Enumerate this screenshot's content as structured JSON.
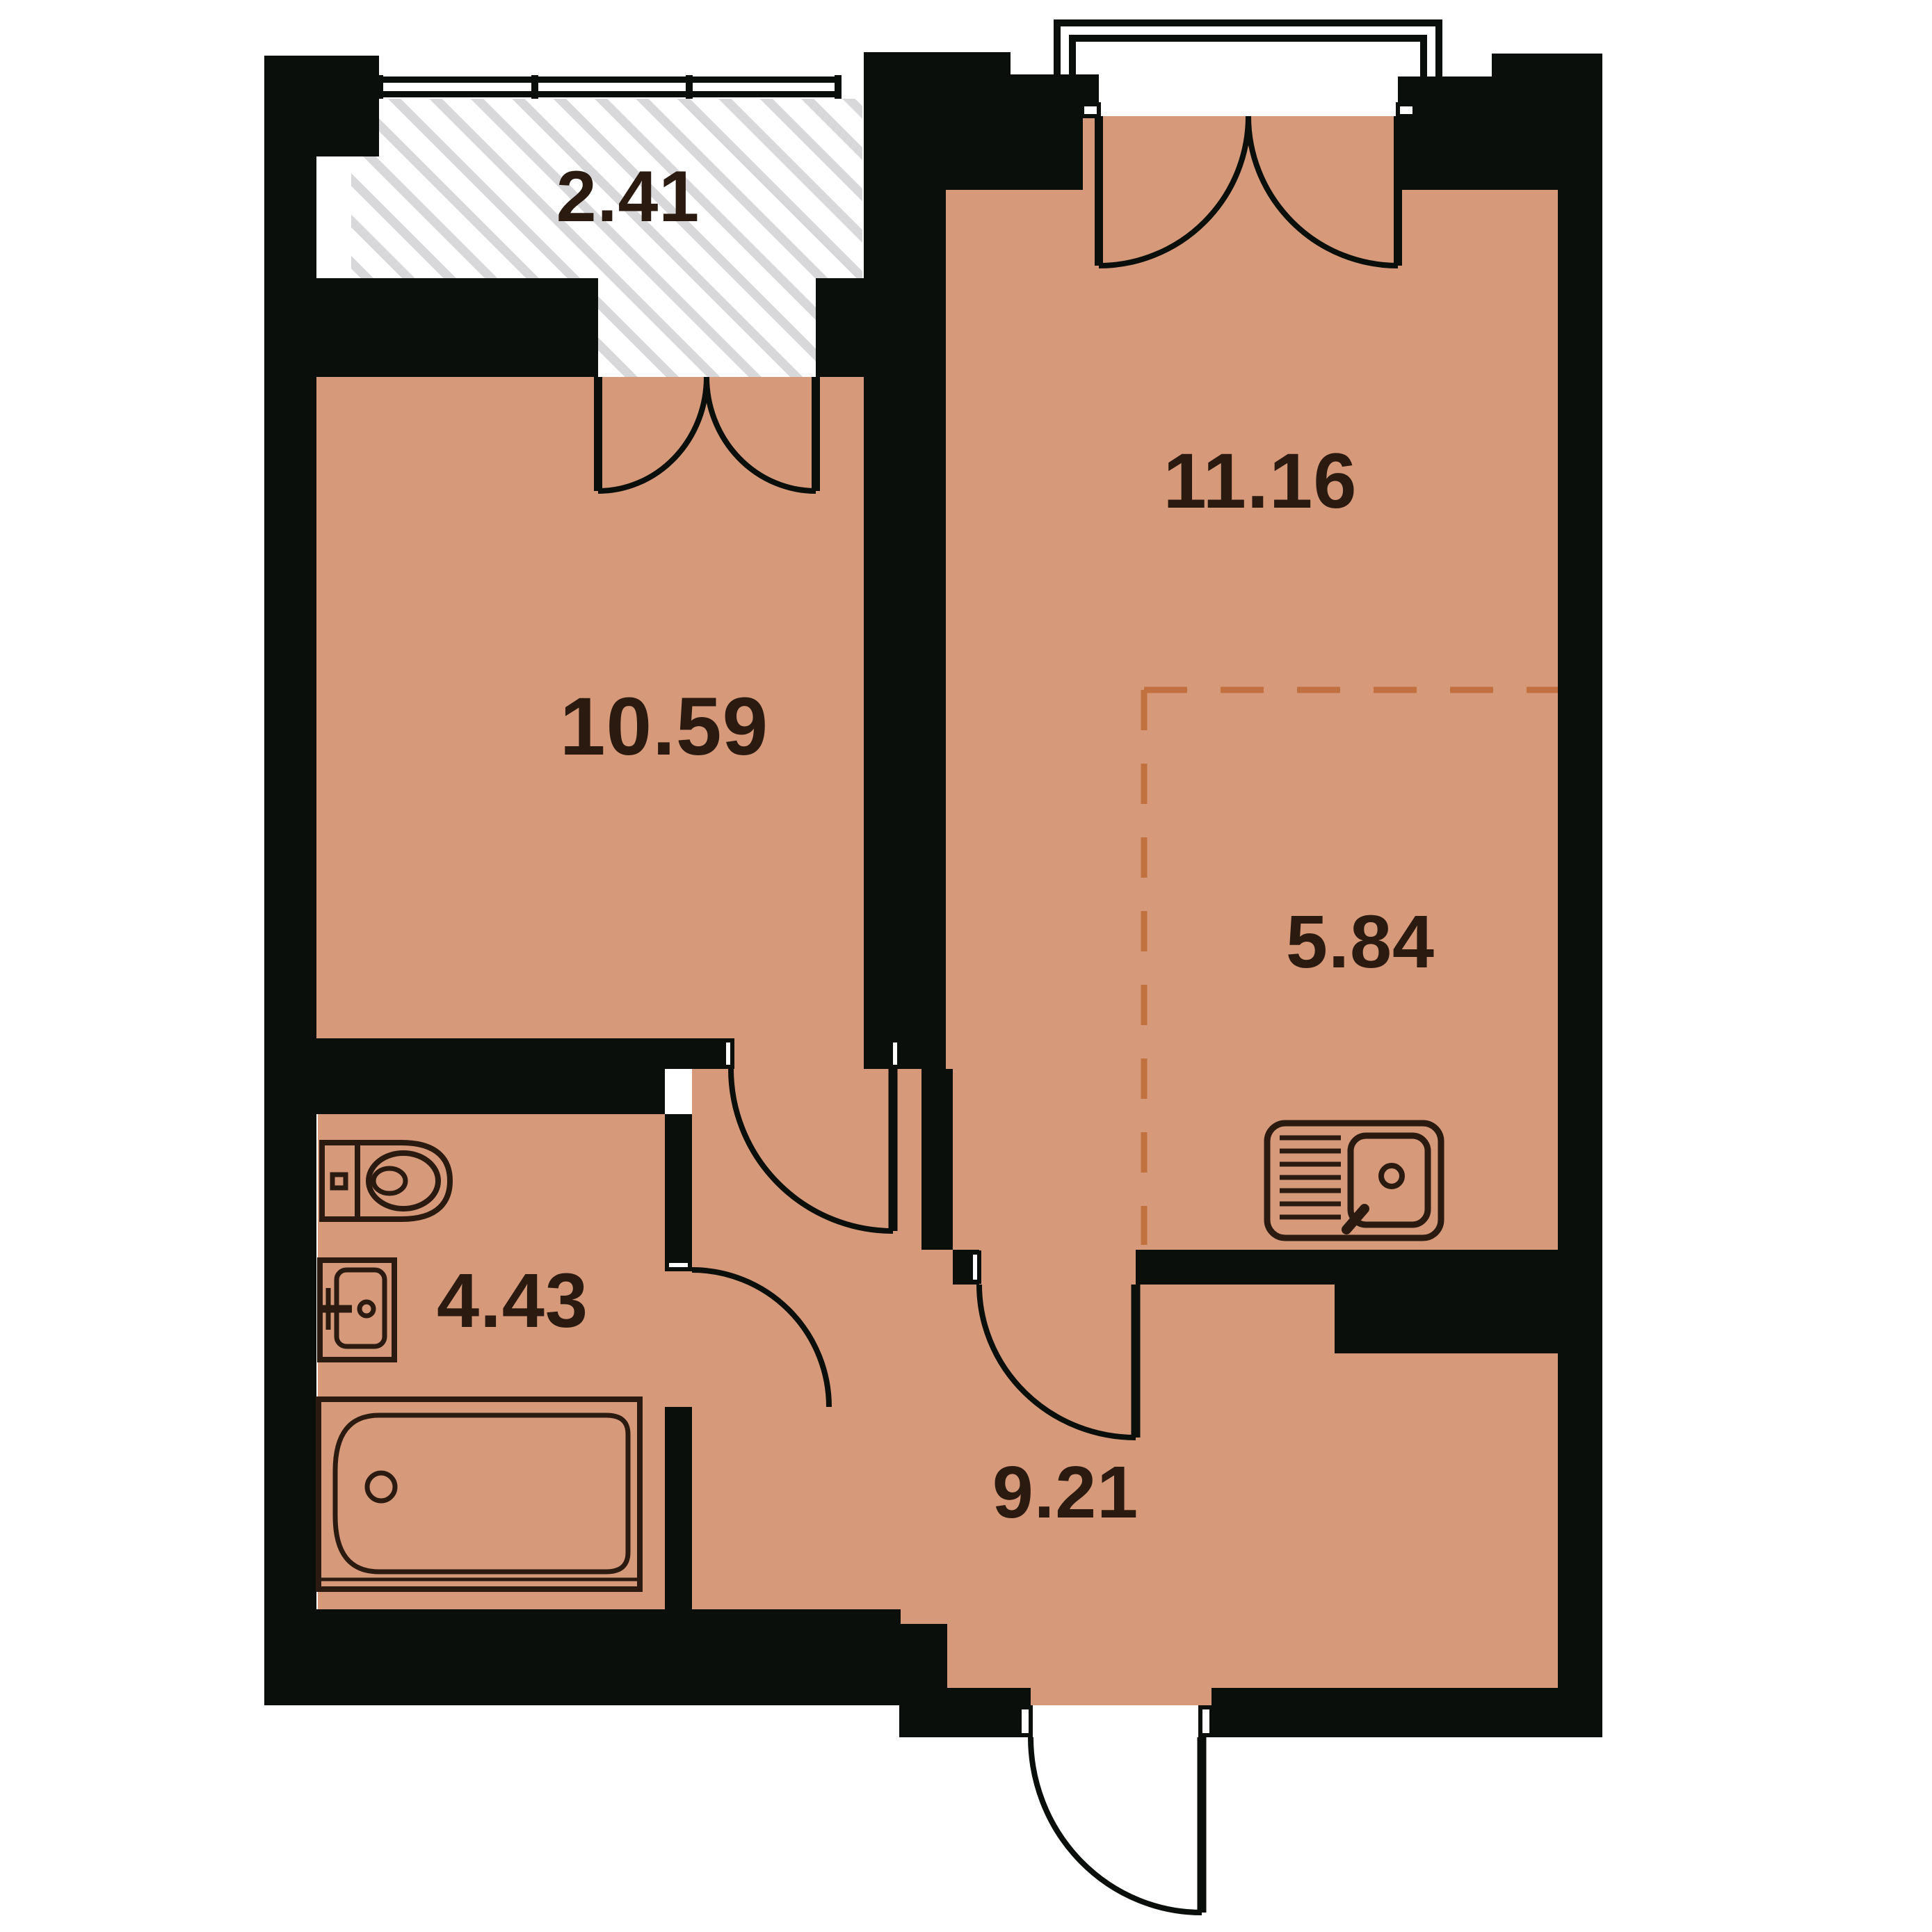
{
  "plan": {
    "type": "apartment-floor-plan",
    "rooms": [
      {
        "id": "balcony",
        "name": "hatched balcony",
        "area_label": "2.41"
      },
      {
        "id": "living-room",
        "name": "living room",
        "area_label": "11.16"
      },
      {
        "id": "bedroom",
        "name": "bedroom",
        "area_label": "10.59"
      },
      {
        "id": "kitchen-zone",
        "name": "kitchen niche (dashed)",
        "area_label": "5.84"
      },
      {
        "id": "bathroom",
        "name": "bathroom",
        "area_label": "4.43"
      },
      {
        "id": "hallway",
        "name": "entrance hall",
        "area_label": "9.21"
      }
    ],
    "icons": [
      "toilet-icon",
      "washbasin-icon",
      "bathtub-icon",
      "kitchen-sink-icon",
      "door-swing-icon",
      "double-door-swing-icon",
      "balcony-railing-icon"
    ],
    "colors": {
      "floor": "#d69a7b",
      "walls": "#0a0f0b",
      "hatch_stripe": "#d8d8da",
      "dashed_zone": "#c0713f",
      "label_text": "#2b1a10",
      "fixture_stroke": "#2b1a10",
      "background": "#ffffff"
    }
  }
}
